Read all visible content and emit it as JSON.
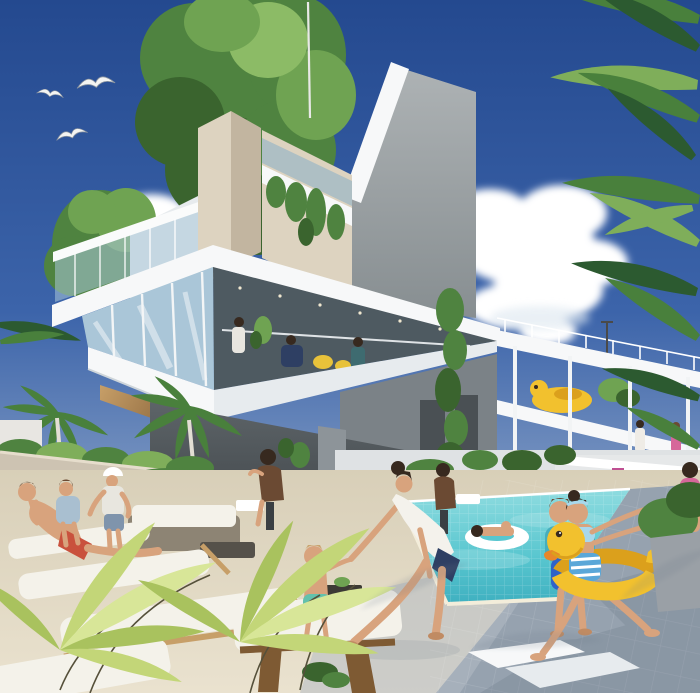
{
  "scene": {
    "type": "architectural-rendering",
    "objects": {
      "sky": "clear blue sky gradient",
      "seagulls": "three seagulls flying upper left",
      "cloud_left": "white cumulus cloud left of building",
      "cloud_right": "white cumulus cloud right of building",
      "rooftop_tree": "large green tree growing from rooftop",
      "left_tree": "small leafy tree behind rooftop terrace",
      "mast": "thin white antenna mast on roof",
      "building": "modern white multi-storey residence with glass facades",
      "corner_column": "beige corner pillar",
      "roof_slab": "tall grey angled roof wall",
      "glass_floor": "glazed living level with people inside",
      "right_wing": "open terraced wing with slabs and columns",
      "play_duck": "yellow duck play structure on terrace",
      "bar": "shaded pool bar under building",
      "pool": "turquoise tiled swimming pool",
      "pool_float": "person lying on white swim ring",
      "woman_white_swimsuit": "woman bending, holding toddler's hand",
      "toddler": "toddler in teal swim diaper",
      "boy_towel": "boy with teal towel and blue shorts at pool edge",
      "girl_duck_ring": "girl running with yellow duck inflatable ring",
      "man_red_shorts": "man lying on lounger",
      "boy_sitting": "boy sitting on lounger",
      "woman_cap": "woman in white cap standing by planter wall",
      "bar_men": "two men seated at bar tables",
      "loungers": "white sun loungers with wooden frames",
      "sofas": "rattan sofa set with white cushions",
      "palms_left": "two palm trees on left horizon",
      "palms_right": "palm fronds along right edge",
      "foreground_fronds": "yellow-green fronds in foreground",
      "colonnade": "white colonnade walkway in far background",
      "deck": "cream and grey tiled pool deck"
    }
  },
  "colors": {
    "sky_top": "#24498f",
    "sky_mid": "#3c64aa",
    "sky_low": "#8da5c8",
    "sky_horizon": "#ccd6e0",
    "cloud": "#ffffff",
    "cloud_shade": "#dde7f0",
    "canopy_dark": "#3a642e",
    "canopy_mid": "#4f8340",
    "canopy_light": "#6fa352",
    "canopy_pale": "#8cbb66",
    "palm_dark": "#2c5a30",
    "palm_mid": "#49803c",
    "palm_light": "#7fae5a",
    "frond_yellow_light": "#d8e698",
    "frond_yellow": "#c3d678",
    "frond_yellow_deep": "#a9c25e",
    "stem_dark": "#55503a",
    "white_face": "#f7f8f9",
    "white_shade": "#e7ebee",
    "white_under": "#ced5da",
    "rail_white": "#fafbfb",
    "glass_light": "#aac6d8",
    "glass_mid": "#8fb2c6",
    "glass_int_dark": "#4e5a61",
    "beige_light": "#ddd3c0",
    "beige_dark": "#c2b5a0",
    "slab_light": "#adb2b4",
    "slab_dark": "#878e91",
    "core_grey": "#7b8287",
    "wood_light": "#c79f68",
    "wood_dark": "#7e5a33",
    "bar_light": "#5d6468",
    "bar_dark": "#3e4347",
    "pool_light": "#8fdce0",
    "pool_mid": "#58c6cf",
    "pool_deep": "#3fb0c0",
    "coping": "#f3edda",
    "deck_cream": "#eae2cf",
    "deck_cream_dark": "#d8cfb8",
    "deck_grey_light": "#b5bcc5",
    "deck_grey": "#96a2af",
    "deck_shadow": "#6e7b8b",
    "far_pale": "#e6e8e9",
    "far_wall": "#dfe2e4",
    "skin": "#d8a37d",
    "skin_shade": "#c08b63",
    "hair_dark": "#37291f",
    "hair_brown": "#6b4a33",
    "duck_yellow": "#f2c12e",
    "duck_deep": "#dba01c",
    "duck_beak": "#e8872a",
    "suit_white": "#f4f2ec",
    "suit_navy": "#2e3f63",
    "boy_shorts": "#2f63c8",
    "towel_teal": "#46aebd",
    "toddler_teal": "#63c1ac",
    "girl_top": "#a8d8ec",
    "girl_stripe": "#5aa7d8",
    "red_shorts": "#c9513d",
    "pink": "#d6679a",
    "magenta": "#bf4f92",
    "boy2_shirt": "#a9bfd0",
    "denim": "#7f94ac",
    "cap_top": "#e8e6df",
    "rattan": "#8d8474",
    "cushion": "#f4f2ea",
    "planter_wall": "#cdc3b2",
    "planter_grey": "#9aa0a6",
    "mast": "#e9e9e7",
    "yellow_accent": "#e8c23a",
    "bird_body": "#f4f4f2"
  }
}
